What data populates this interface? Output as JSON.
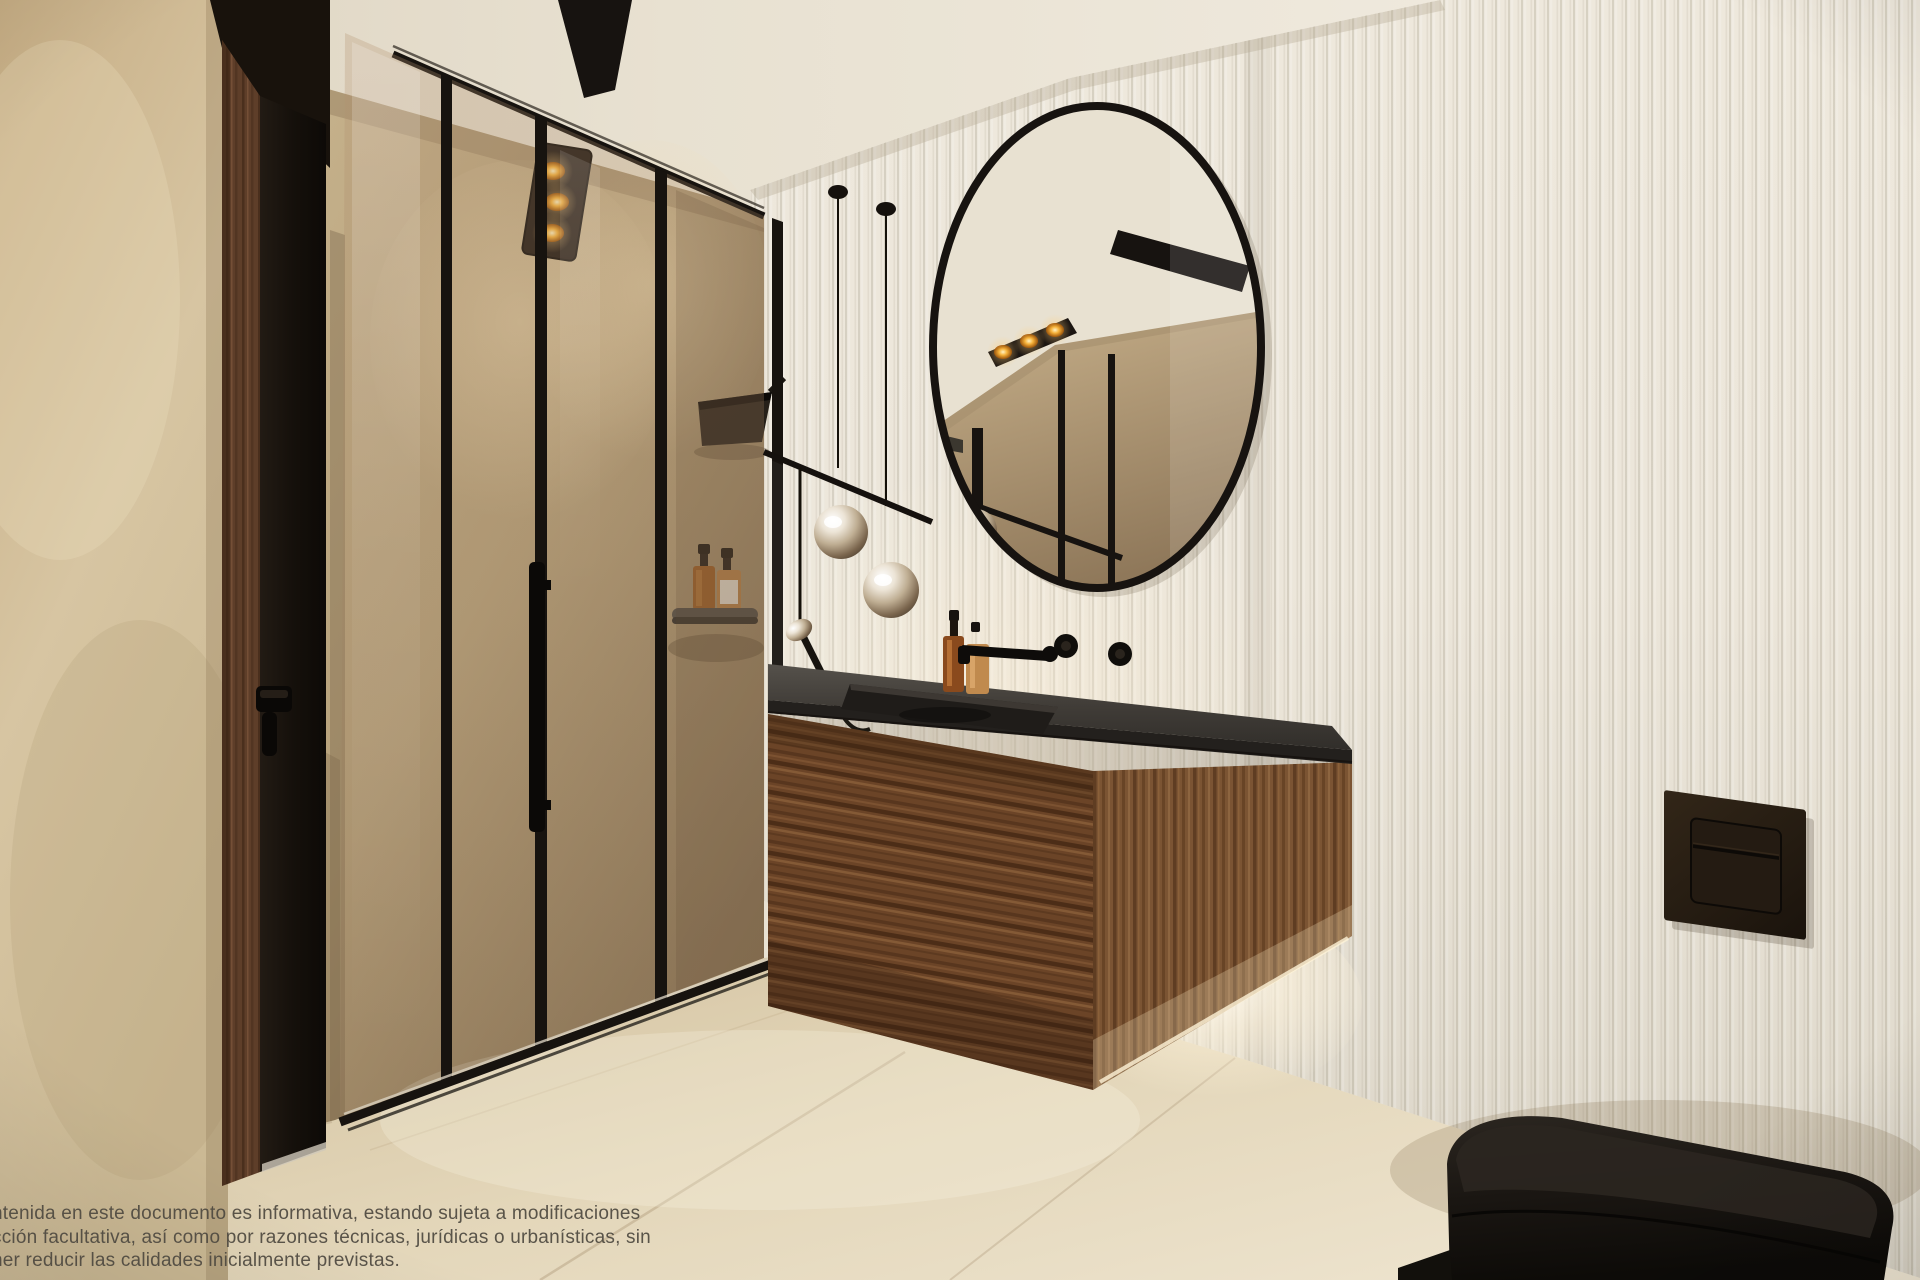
{
  "disclaimer": {
    "lines": [
      "ntenida en este documento es informativa, estando sujeta a modificaciones",
      "cción facultativa, así como por razones técnicas, jurídicas o urbanísticas, sin",
      "ner reducir las calidades inicialmente previstas."
    ]
  },
  "palette": {
    "ceiling": "#e9e2d3",
    "wall_right": "#ebe5d9",
    "wall_stone": "#c0ab86",
    "wall_tan": "#d0bc96",
    "floor": "#e4d7ba",
    "wood_dark": "#6d4628",
    "wood_light": "#7c5433",
    "counter": "#3b3733",
    "frame_black": "#17130f",
    "glass_tint": "#a98a66",
    "glow_warm": "#ffd98a",
    "chrome": "#d9cfc0",
    "toilet_black": "#14110d",
    "text": "#4e4940"
  }
}
